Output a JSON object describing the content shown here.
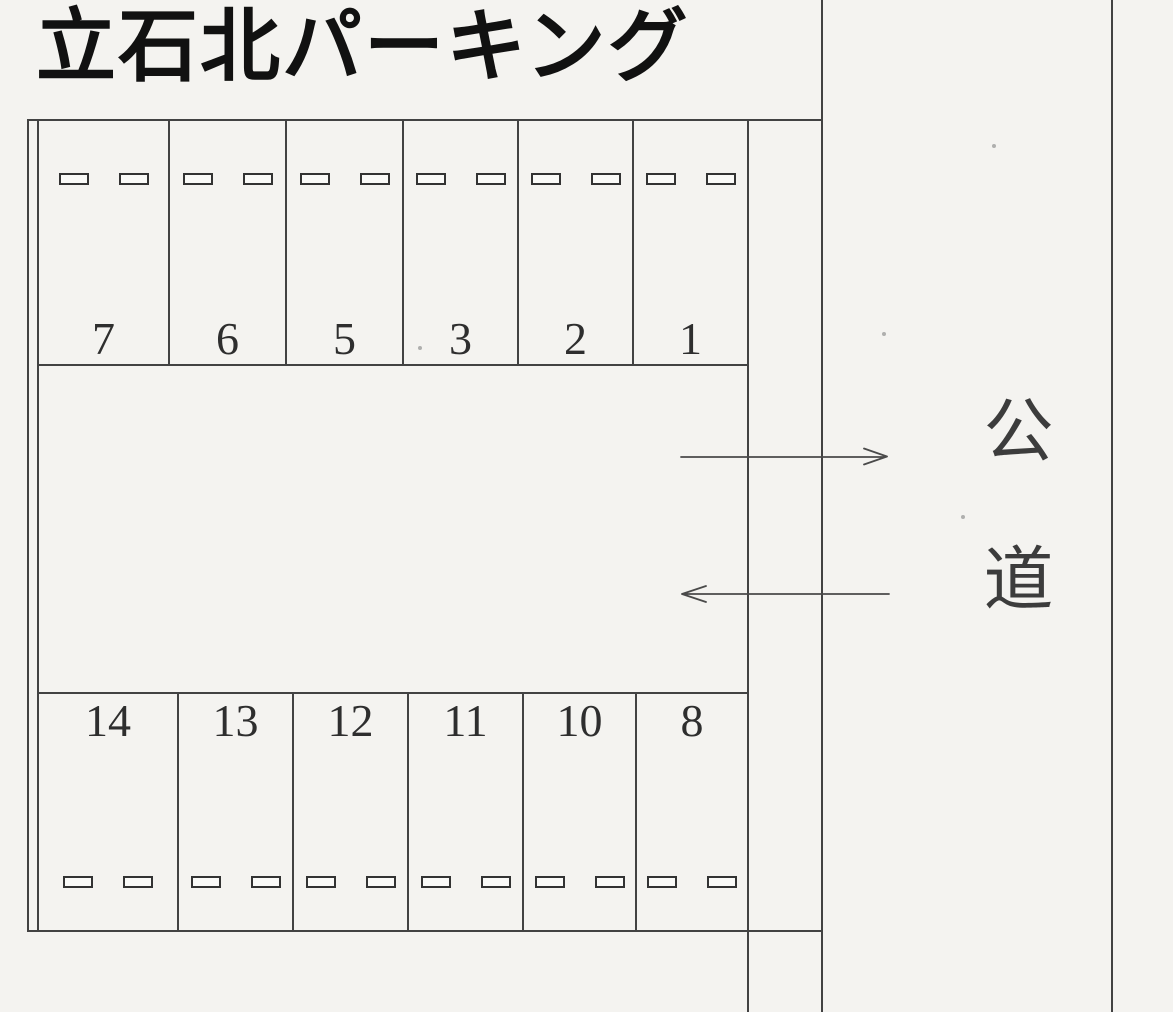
{
  "title": "立石北パーキング",
  "road": {
    "label": "公道"
  },
  "lot": {
    "top_row": {
      "position": "top",
      "wheel_stops_per_space": 2,
      "spaces": [
        {
          "number": "7"
        },
        {
          "number": "6"
        },
        {
          "number": "5"
        },
        {
          "number": "3"
        },
        {
          "number": "2"
        },
        {
          "number": "1"
        }
      ]
    },
    "bottom_row": {
      "position": "bottom",
      "wheel_stops_per_space": 2,
      "spaces": [
        {
          "number": "14"
        },
        {
          "number": "13"
        },
        {
          "number": "12"
        },
        {
          "number": "11"
        },
        {
          "number": "10"
        },
        {
          "number": "8"
        }
      ]
    }
  },
  "arrows": [
    {
      "name": "exit-arrow",
      "direction": "right"
    },
    {
      "name": "entry-arrow",
      "direction": "left"
    }
  ],
  "colors": {
    "background": "#f4f3f0",
    "line": "#424242",
    "ink": "#111111"
  }
}
